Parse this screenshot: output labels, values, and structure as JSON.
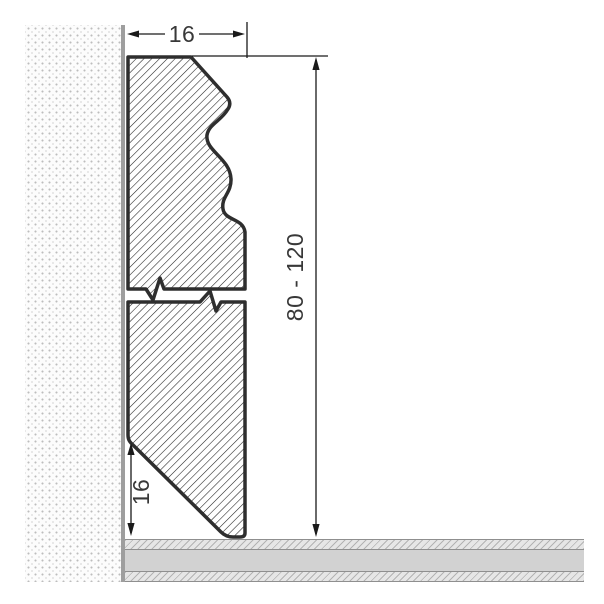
{
  "drawing": {
    "subject": "skirting-board-profile-cross-section",
    "dimensions": {
      "width": {
        "label": "16"
      },
      "height": {
        "label": "80 - 120"
      },
      "bottom_bevel": {
        "label": "16"
      }
    },
    "colors": {
      "profile_outline": "#2e2e2e",
      "profile_hatch": "#1c1c1c",
      "dimension_line": "#1a1a1a",
      "dimension_text": "#383838",
      "wall_dot": "#bdbdbd",
      "wall_edge": "#9e9e9e",
      "floor_band": "#d2d2d2",
      "floor_hatch_bg": "#e6e6e6",
      "floor_hatch_line": "#b3b3b3",
      "floor_border": "#8f8f8f",
      "background": "#ffffff"
    }
  }
}
